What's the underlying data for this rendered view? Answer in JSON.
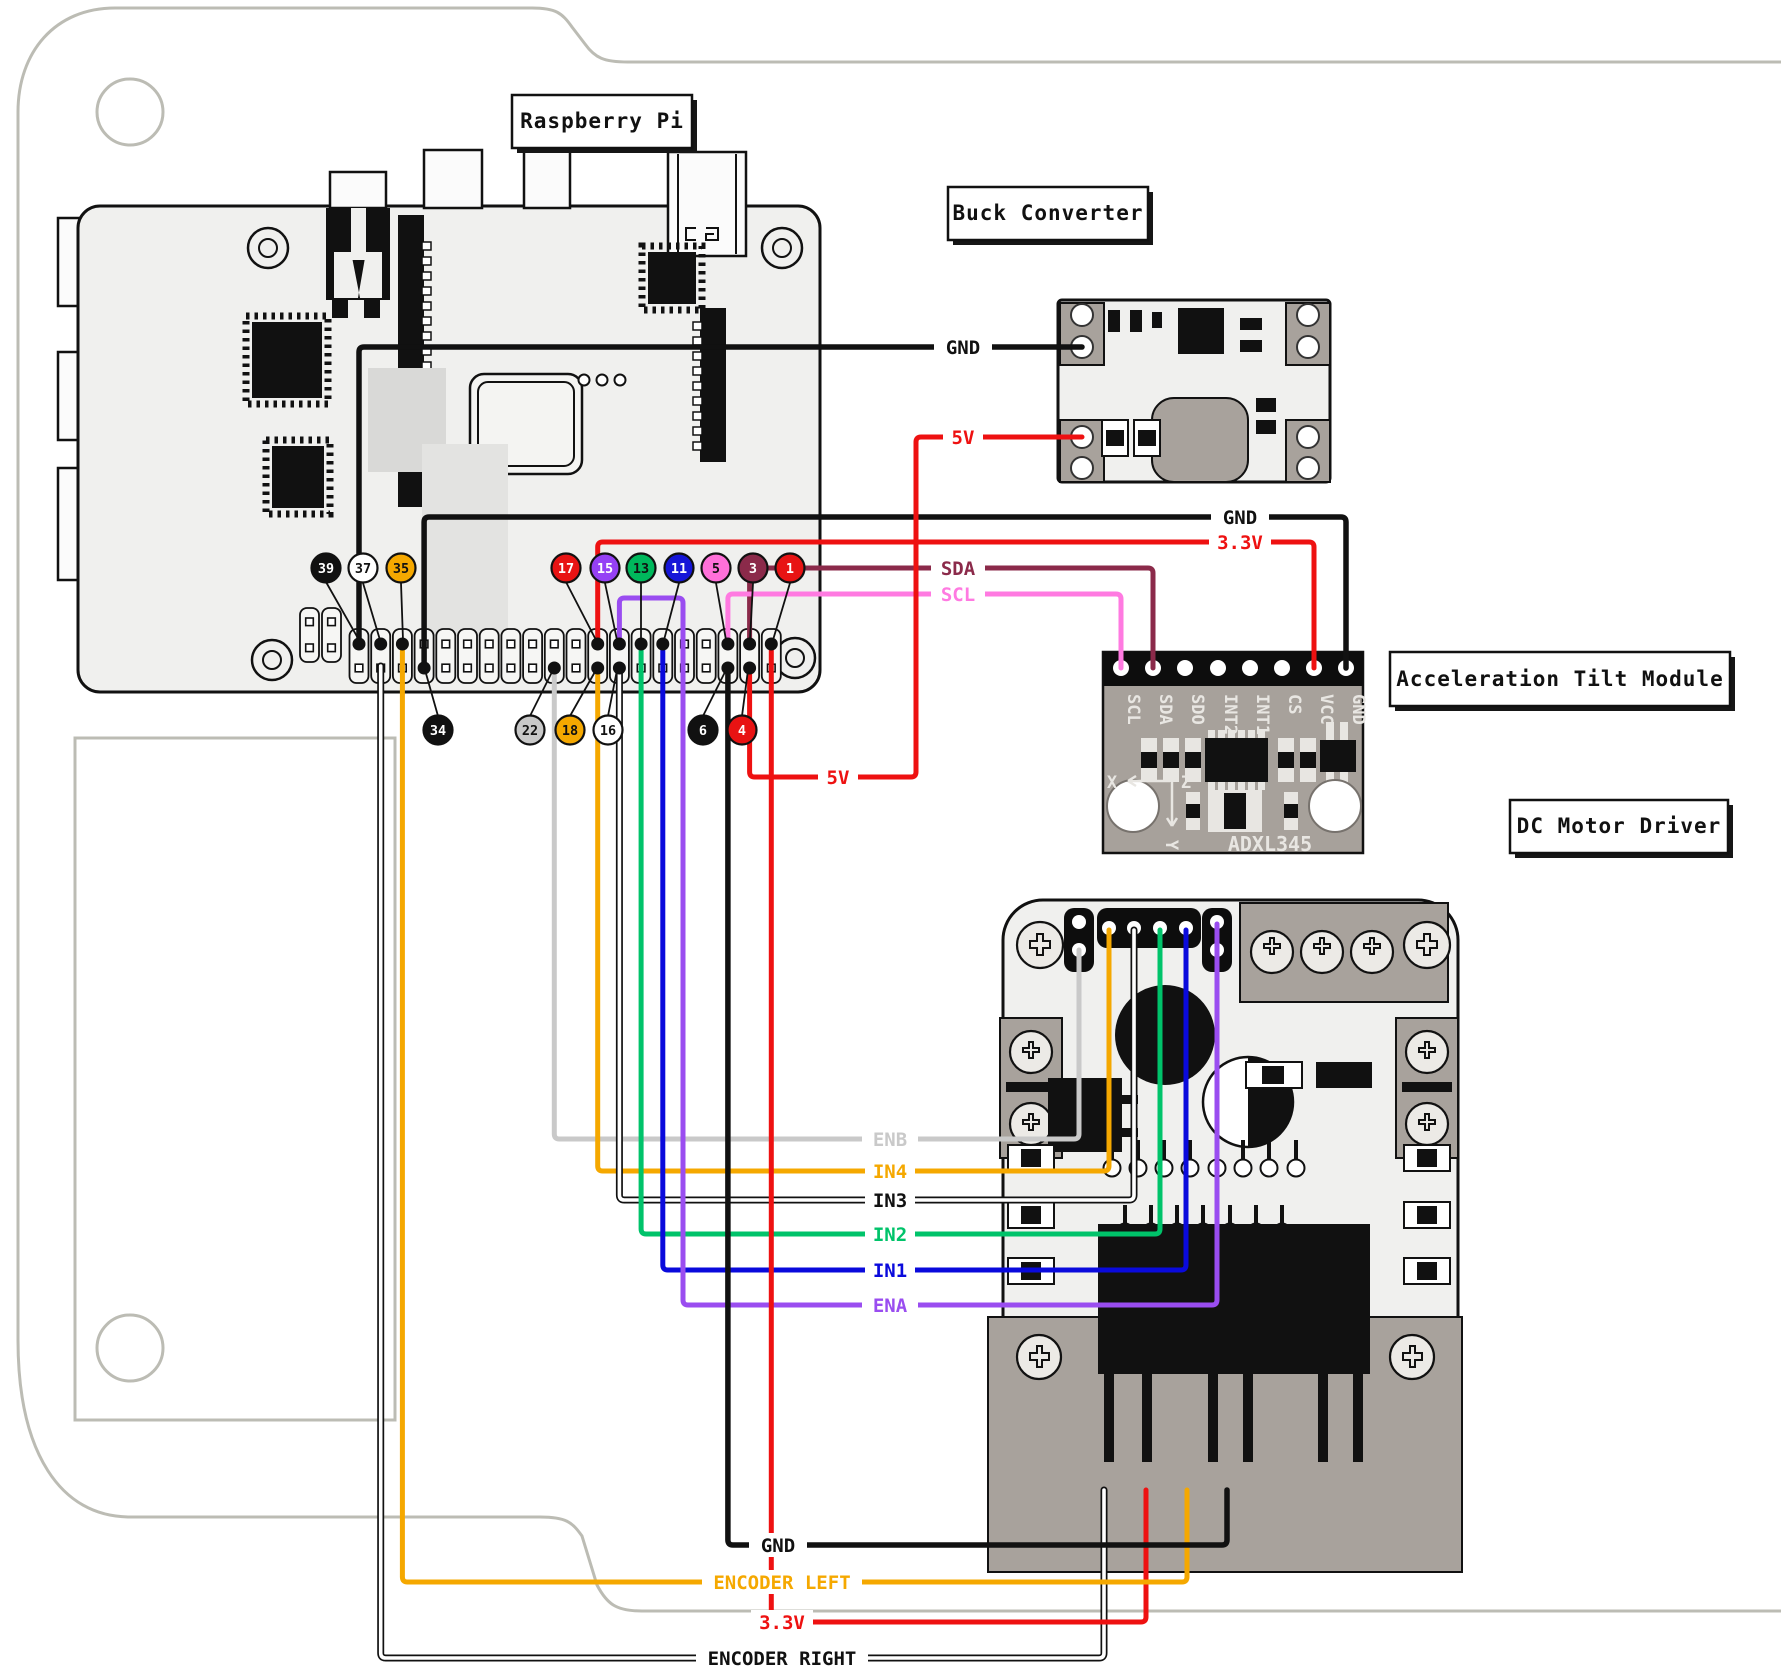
{
  "titles": {
    "raspberry_pi": "Raspberry Pi",
    "buck_converter": "Buck Converter",
    "tilt_module": "Acceleration Tilt Module",
    "motor_driver": "DC Motor Driver"
  },
  "adxl": {
    "pin_labels": [
      "SCL",
      "SDA",
      "SDO",
      "INT2",
      "INT1",
      "CS",
      "VCC",
      "GND"
    ],
    "chip_label": "ADXL345",
    "axis_x": "X",
    "axis_y": "Y",
    "axis_z": "Z"
  },
  "pi_pins_top": [
    {
      "n": "39",
      "bg": "#111111",
      "fg": "#ffffff"
    },
    {
      "n": "37",
      "bg": "#ffffff",
      "fg": "#111111"
    },
    {
      "n": "35",
      "bg": "#f5a800",
      "fg": "#111111"
    },
    {
      "n": "17",
      "bg": "#e81313",
      "fg": "#ffffff"
    },
    {
      "n": "15",
      "bg": "#9540f5",
      "fg": "#ffffff"
    },
    {
      "n": "13",
      "bg": "#00b85c",
      "fg": "#111111"
    },
    {
      "n": "11",
      "bg": "#1616d8",
      "fg": "#ffffff"
    },
    {
      "n": "5",
      "bg": "#ff70d9",
      "fg": "#111111"
    },
    {
      "n": "3",
      "bg": "#8b2a4a",
      "fg": "#ffffff"
    },
    {
      "n": "1",
      "bg": "#e81313",
      "fg": "#ffffff"
    }
  ],
  "pi_pins_bottom": [
    {
      "n": "34",
      "bg": "#111111",
      "fg": "#ffffff"
    },
    {
      "n": "22",
      "bg": "#c8c8c8",
      "fg": "#111111"
    },
    {
      "n": "18",
      "bg": "#f5a800",
      "fg": "#111111"
    },
    {
      "n": "16",
      "bg": "#ffffff",
      "fg": "#111111"
    },
    {
      "n": "6",
      "bg": "#111111",
      "fg": "#ffffff"
    },
    {
      "n": "4",
      "bg": "#e81313",
      "fg": "#ffffff"
    }
  ],
  "wires": {
    "gnd_buck": {
      "label": "GND",
      "color": "#111111"
    },
    "v5_buck": {
      "label": "5V",
      "color": "#ee1111"
    },
    "gnd_adxl": {
      "label": "GND",
      "color": "#111111"
    },
    "v33_adxl": {
      "label": "3.3V",
      "color": "#ee1111"
    },
    "sda": {
      "label": "SDA",
      "color": "#8b2a4a"
    },
    "scl": {
      "label": "SCL",
      "color": "#ff7ae1"
    },
    "v5_mid": {
      "label": "5V",
      "color": "#ee1111"
    },
    "enb": {
      "label": "ENB",
      "color": "#c9c9c9"
    },
    "in4": {
      "label": "IN4",
      "color": "#f5a800"
    },
    "in3": {
      "label": "IN3",
      "color": "#111111"
    },
    "in2": {
      "label": "IN2",
      "color": "#00c36a"
    },
    "in1": {
      "label": "IN1",
      "color": "#0a0adc"
    },
    "ena": {
      "label": "ENA",
      "color": "#9a4df0"
    },
    "gnd_bottom": {
      "label": "GND",
      "color": "#111111"
    },
    "encoder_left": {
      "label": "ENCODER LEFT",
      "color": "#f5a800"
    },
    "v33_bottom": {
      "label": "3.3V",
      "color": "#ee1111"
    },
    "encoder_right": {
      "label": "ENCODER RIGHT",
      "color": "#111111"
    }
  }
}
